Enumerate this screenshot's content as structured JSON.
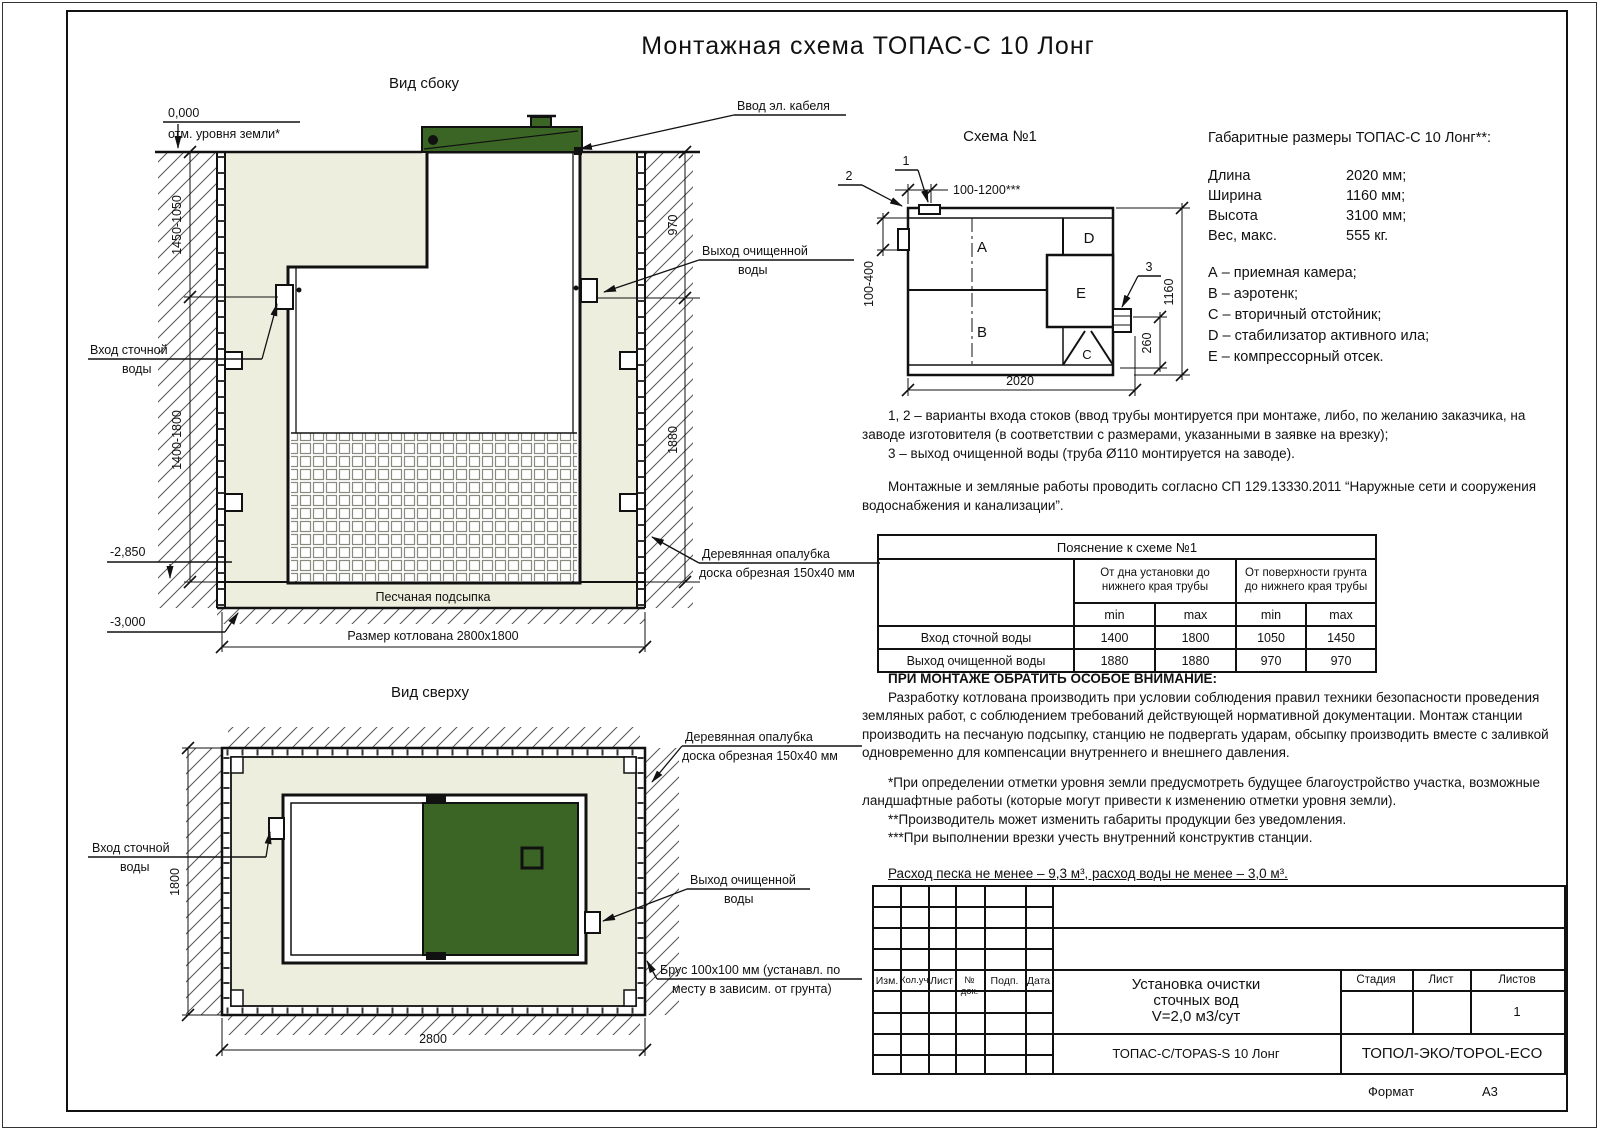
{
  "page": {
    "title": "Монтажная схема ТОПАС-С 10 Лонг",
    "format_label": "Формат",
    "format_value": "А3"
  },
  "side_view": {
    "title": "Вид сбоку",
    "zero_mark": "0,000",
    "ground_label": "отм. уровня земли*",
    "cable_label": "Ввод эл. кабеля",
    "inlet_label_1": "Вход сточной",
    "inlet_label_2": "воды",
    "outlet_label_1": "Выход очищенной",
    "outlet_label_2": "воды",
    "formwork_label_1": "Деревянная опалубка",
    "formwork_label_2": "доска обрезная 150х40 мм",
    "bedding_label": "Песчаная подсыпка",
    "pit_label": "Размер котлована 2800х1800",
    "mark_minus_2850": "-2,850",
    "mark_minus_3000": "-3,000",
    "dim_depth_upper": "1450-1050",
    "dim_depth_lower": "1400-1800",
    "dim_970": "970",
    "dim_1880": "1880"
  },
  "top_view": {
    "title": "Вид сверху",
    "inlet_label_1": "Вход сточной",
    "inlet_label_2": "воды",
    "outlet_label_1": "Выход очищенной",
    "outlet_label_2": "воды",
    "formwork_label_1": "Деревянная опалубка",
    "formwork_label_2": "доска обрезная 150х40 мм",
    "beam_label_1": "Брус 100х100 мм (устанавл. по",
    "beam_label_2": "месту в зависим. от грунта)",
    "dim_1800": "1800",
    "dim_2800": "2800"
  },
  "schema": {
    "title": "Схема №1",
    "marker_1": "1",
    "marker_2": "2",
    "marker_3": "3",
    "dim_top": "100-1200***",
    "dim_left": "100-400",
    "dim_right": "1160",
    "dim_260": "260",
    "dim_2020": "2020",
    "chamber_a": "A",
    "chamber_b": "B",
    "chamber_c": "C",
    "chamber_d": "D",
    "chamber_e": "E"
  },
  "specs": {
    "heading": "Габаритные размеры ТОПАС-С 10 Лонг**:",
    "rows": [
      {
        "name": "Длина",
        "value": "2020 мм;"
      },
      {
        "name": "Ширина",
        "value": "1160 мм;"
      },
      {
        "name": "Высота",
        "value": "3100 мм;"
      },
      {
        "name": "Вес, макс.",
        "value": "555 кг."
      }
    ],
    "legend": [
      "А – приемная камера;",
      "В – аэротенк;",
      "С – вторичный отстойник;",
      "D – стабилизатор активного ила;",
      "Е – компрессорный отсек."
    ]
  },
  "notes": {
    "p1": "1, 2 – варианты входа стоков (ввод трубы монтируется при монтаже, либо, по желанию заказчика, на заводе изготовителя (в соответствии с размерами, указанными в заявке на врезку);",
    "p2": "3 – выход очищенной воды (труба Ø110 монтируется на заводе).",
    "p3": "Монтажные и земляные работы проводить согласно СП 129.13330.2011 “Наружные сети и сооружения водоснабжения и канализации”."
  },
  "table": {
    "title": "Пояснение к схеме №1",
    "group1": "От дна установки до нижнего края трубы",
    "group2": "От поверхности грунта до нижнего края трубы",
    "min1": "min",
    "max1": "max",
    "min2": "min",
    "max2": "max",
    "rows": [
      {
        "name": "Вход сточной воды",
        "c1": "1400",
        "c2": "1800",
        "c3": "1050",
        "c4": "1450"
      },
      {
        "name": "Выход очищенной воды",
        "c1": "1880",
        "c2": "1880",
        "c3": "970",
        "c4": "970"
      }
    ]
  },
  "attention": {
    "heading": "ПРИ МОНТАЖЕ ОБРАТИТЬ ОСОБОЕ ВНИМАНИЕ:",
    "body": "Разработку котлована производить при условии соблюдения правил техники безопасности проведения земляных работ, с соблюдением требований действующей нормативной документации. Монтаж станции производить на песчаную подсыпку, станцию не подвергать ударам, обсыпку производить вместе с заливкой одновременно для компенсации внутреннего и внешнего давления.",
    "note1": "*При определении отметки уровня земли предусмотреть будущее благоустройство участка, возможные ландшафтные работы (которые могут привести к изменению отметки уровня земли).",
    "note2": "**Производитель может изменить габариты продукции без уведомления.",
    "note3": "***При выполнении врезки учесть внутренний конструктив станции.",
    "consumption": "Расход песка не менее – 9,3 м³, расход воды не менее – 3,0 м³."
  },
  "title_block": {
    "cols": [
      "Изм.",
      "Кол.уч.",
      "Лист",
      "№ док.",
      "Подп.",
      "Дата"
    ],
    "doc_line1": "Установка очистки",
    "doc_line2": "сточных вод",
    "doc_line3": "V=2,0 м3/сут",
    "stage": "Стадия",
    "sheet": "Лист",
    "sheets": "Листов",
    "sheets_value": "1",
    "product": "ТОПАС-С/TOPAS-S 10 Лонг",
    "company": "ТОПОЛ-ЭКО/TOPOL-ECO"
  }
}
